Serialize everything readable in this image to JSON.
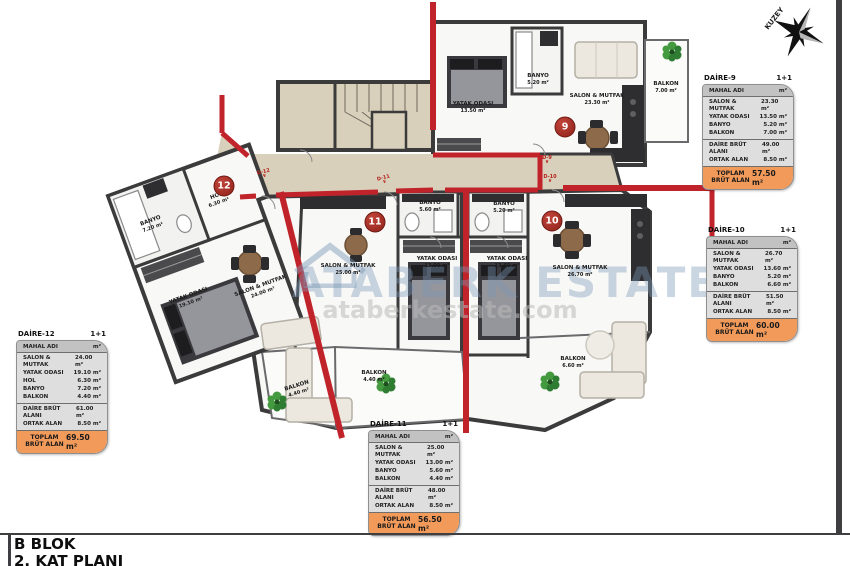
{
  "sheet": {
    "block_title": "B BLOK",
    "plan_title": "2. KAT PLANI",
    "compass_label": "KUZEY"
  },
  "watermark": {
    "brand": "ATABERK ESTATE",
    "url": "ataberkestate.com"
  },
  "colors": {
    "accent_red": "#c1232b",
    "wall_dark": "#3b3b3c",
    "corridor_beige": "#d9d0bb",
    "table_total_orange": "#f29a5a",
    "marker_red": "#8e221a",
    "plant_green": "#2e7d32"
  },
  "plan": {
    "markers": [
      {
        "no": "9",
        "x": 565,
        "y": 127
      },
      {
        "no": "10",
        "x": 552,
        "y": 221
      },
      {
        "no": "11",
        "x": 375,
        "y": 222
      },
      {
        "no": "12",
        "x": 224,
        "y": 186
      }
    ],
    "door_labels": [
      {
        "text": "D-9",
        "x": 547,
        "y": 160,
        "rot": 0
      },
      {
        "text": "D-10",
        "x": 550,
        "y": 179,
        "rot": 0
      },
      {
        "text": "D-11",
        "x": 384,
        "y": 180,
        "rot": -15
      },
      {
        "text": "D-12",
        "x": 264,
        "y": 174,
        "rot": -15
      }
    ],
    "rooms": [
      {
        "name": "YATAK ODASI",
        "area": "13.50 m²",
        "x": 473,
        "y": 108,
        "rot": 0
      },
      {
        "name": "BANYO",
        "area": "5.20 m²",
        "x": 538,
        "y": 80,
        "rot": 0
      },
      {
        "name": "SALON & MUTFAK",
        "area": "23.30 m²",
        "x": 597,
        "y": 100,
        "rot": 0
      },
      {
        "name": "BALKON",
        "area": "7.00 m²",
        "x": 666,
        "y": 88,
        "rot": 0
      },
      {
        "name": "BANYO",
        "area": "5.60 m²",
        "x": 430,
        "y": 207,
        "rot": 0
      },
      {
        "name": "BANYO",
        "area": "5.20 m²",
        "x": 504,
        "y": 208,
        "rot": 0
      },
      {
        "name": "YATAK ODASI",
        "area": "13.00 m²",
        "x": 437,
        "y": 263,
        "rot": 0
      },
      {
        "name": "YATAK ODASI",
        "area": "13.60 m²",
        "x": 507,
        "y": 263,
        "rot": 0
      },
      {
        "name": "SALON & MUTFAK",
        "area": "25.00 m²",
        "x": 348,
        "y": 270,
        "rot": 0
      },
      {
        "name": "SALON & MUTFAK",
        "area": "26.70 m²",
        "x": 580,
        "y": 272,
        "rot": 0
      },
      {
        "name": "BALKON",
        "area": "4.40 m²",
        "x": 298,
        "y": 390,
        "rot": -17
      },
      {
        "name": "BALKON",
        "area": "4.40 m²",
        "x": 374,
        "y": 377,
        "rot": 0
      },
      {
        "name": "BALKON",
        "area": "6.60 m²",
        "x": 573,
        "y": 363,
        "rot": 0
      },
      {
        "name": "HOL",
        "area": "6.30 m²",
        "x": 218,
        "y": 200,
        "rot": -20
      },
      {
        "name": "BANYO",
        "area": "7.20 m²",
        "x": 152,
        "y": 225,
        "rot": -20
      },
      {
        "name": "YATAK ODASI",
        "area": "19.10 m²",
        "x": 190,
        "y": 300,
        "rot": -20
      },
      {
        "name": "SALON & MUTFAK",
        "area": "24.00 m²",
        "x": 262,
        "y": 290,
        "rot": -20
      }
    ],
    "plants": [
      {
        "x": 672,
        "y": 52
      },
      {
        "x": 277,
        "y": 402
      },
      {
        "x": 386,
        "y": 384
      },
      {
        "x": 550,
        "y": 382
      }
    ]
  },
  "tables": [
    {
      "id": "DAİRE-9",
      "type": "1+1",
      "x": 702,
      "y": 74,
      "col_name": "MAHAL ADI",
      "col_unit": "m²",
      "rows": [
        [
          "SALON & MUTFAK",
          "23.30 m²"
        ],
        [
          "YATAK ODASI",
          "13.50 m²"
        ],
        [
          "BANYO",
          "5.20 m²"
        ],
        [
          "BALKON",
          "7.00 m²"
        ]
      ],
      "summary": [
        [
          "DAİRE BRÜT ALANI",
          "49.00 m²"
        ],
        [
          "ORTAK ALAN",
          "8.50 m²"
        ]
      ],
      "total_label": "TOPLAM BRÜT ALAN",
      "total": "57.50 m²"
    },
    {
      "id": "DAİRE-10",
      "type": "1+1",
      "x": 706,
      "y": 226,
      "col_name": "MAHAL ADI",
      "col_unit": "m²",
      "rows": [
        [
          "SALON & MUTFAK",
          "26.70 m²"
        ],
        [
          "YATAK ODASI",
          "13.60 m²"
        ],
        [
          "BANYO",
          "5.20 m²"
        ],
        [
          "BALKON",
          "6.60 m²"
        ]
      ],
      "summary": [
        [
          "DAİRE BRÜT ALANI",
          "51.50 m²"
        ],
        [
          "ORTAK ALAN",
          "8.50 m²"
        ]
      ],
      "total_label": "TOPLAM BRÜT ALAN",
      "total": "60.00 m²"
    },
    {
      "id": "DAİRE-11",
      "type": "1+1",
      "x": 368,
      "y": 420,
      "col_name": "MAHAL ADI",
      "col_unit": "m²",
      "rows": [
        [
          "SALON & MUTFAK",
          "25.00 m²"
        ],
        [
          "YATAK ODASI",
          "13.00 m²"
        ],
        [
          "BANYO",
          "5.60 m²"
        ],
        [
          "BALKON",
          "4.40 m²"
        ]
      ],
      "summary": [
        [
          "DAİRE BRÜT ALANI",
          "48.00 m²"
        ],
        [
          "ORTAK ALAN",
          "8.50 m²"
        ]
      ],
      "total_label": "TOPLAM BRÜT ALAN",
      "total": "56.50 m²"
    },
    {
      "id": "DAİRE-12",
      "type": "1+1",
      "x": 16,
      "y": 330,
      "col_name": "MAHAL ADI",
      "col_unit": "m²",
      "rows": [
        [
          "SALON & MUTFAK",
          "24.00 m²"
        ],
        [
          "YATAK ODASI",
          "19.10 m²"
        ],
        [
          "HOL",
          "6.30 m²"
        ],
        [
          "BANYO",
          "7.20 m²"
        ],
        [
          "BALKON",
          "4.40 m²"
        ]
      ],
      "summary": [
        [
          "DAİRE BRÜT ALANI",
          "61.00 m²"
        ],
        [
          "ORTAK ALAN",
          "8.50 m²"
        ]
      ],
      "total_label": "TOPLAM BRÜT ALAN",
      "total": "69.50 m²"
    }
  ]
}
